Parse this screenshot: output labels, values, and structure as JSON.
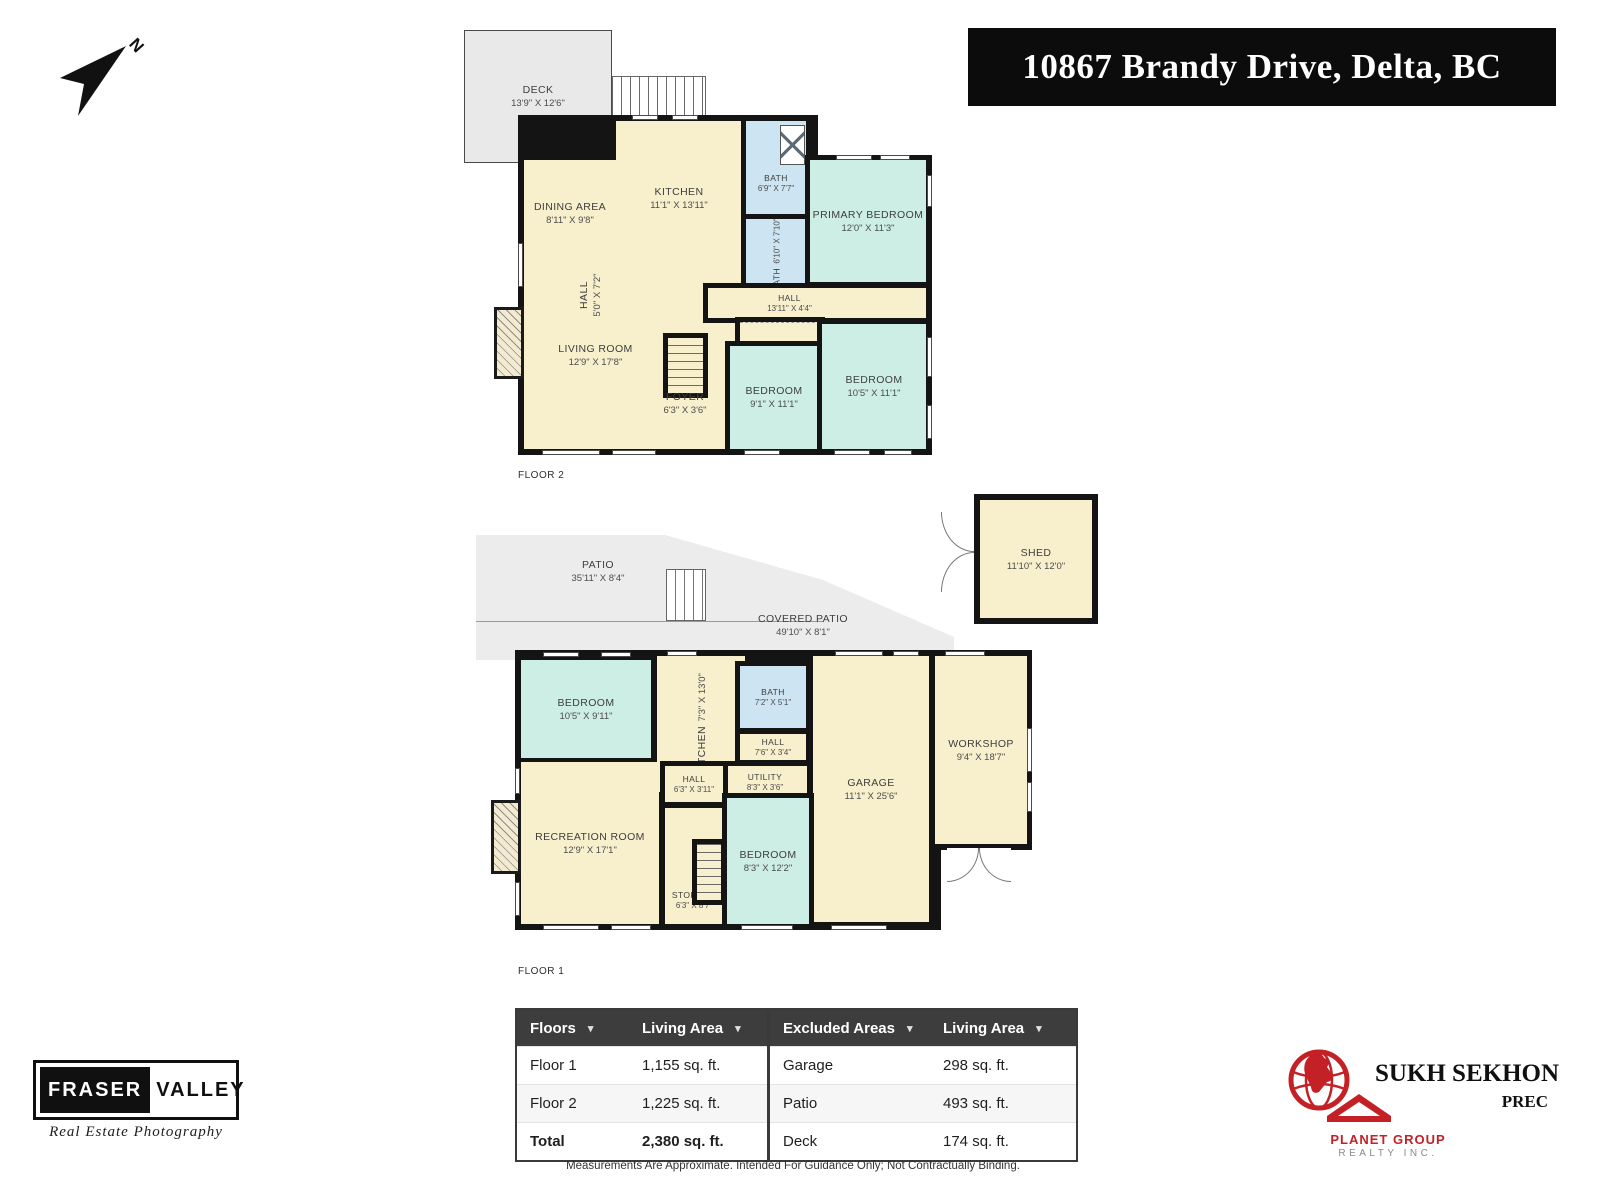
{
  "banner": {
    "text": "10867 Brandy Drive, Delta, BC",
    "bg": "#0c0c0c",
    "fg": "#ffffff"
  },
  "compass": {
    "label": "N"
  },
  "floor2": {
    "caption": "FLOOR 2",
    "rooms": {
      "deck": {
        "name": "DECK",
        "dims": "13'9\" X 12'6\""
      },
      "dining": {
        "name": "DINING AREA",
        "dims": "8'11\" X 9'8\""
      },
      "kitchen": {
        "name": "KITCHEN",
        "dims": "11'1\" X 13'11\""
      },
      "bath_upper": {
        "name": "BATH",
        "dims": "6'9\" X 7'7\""
      },
      "bath_lower": {
        "name": "BATH",
        "dims": "6'10\" X 7'10\""
      },
      "primary": {
        "name": "PRIMARY BEDROOM",
        "dims": "12'0\" X 11'3\""
      },
      "hall_small": {
        "name": "HALL",
        "dims": "5'0\" X 7'2\""
      },
      "hall": {
        "name": "HALL",
        "dims": "13'11\" X 4'4\""
      },
      "living": {
        "name": "LIVING ROOM",
        "dims": "12'9\" X 17'8\""
      },
      "foyer": {
        "name": "FOYER",
        "dims": "6'3\" X 3'6\""
      },
      "bedroom_a": {
        "name": "BEDROOM",
        "dims": "9'1\" X 11'1\""
      },
      "bedroom_b": {
        "name": "BEDROOM",
        "dims": "10'5\" X 11'1\""
      }
    }
  },
  "floor1": {
    "caption": "FLOOR 1",
    "rooms": {
      "patio": {
        "name": "PATIO",
        "dims": "35'11\" X 8'4\""
      },
      "covered_patio": {
        "name": "COVERED PATIO",
        "dims": "49'10\" X 8'1\""
      },
      "shed": {
        "name": "SHED",
        "dims": "11'10\" X 12'0\""
      },
      "bedroom_a": {
        "name": "BEDROOM",
        "dims": "10'5\" X 9'11\""
      },
      "kitchen": {
        "name": "KITCHEN",
        "dims": "7'3\" X 13'0\""
      },
      "bath": {
        "name": "BATH",
        "dims": "7'2\" X 5'1\""
      },
      "hall_a": {
        "name": "HALL",
        "dims": "7'6\" X 3'4\""
      },
      "utility": {
        "name": "UTILITY",
        "dims": "8'3\" X 3'6\""
      },
      "garage": {
        "name": "GARAGE",
        "dims": "11'1\" X 25'6\""
      },
      "workshop": {
        "name": "WORKSHOP",
        "dims": "9'4\" X 18'7\""
      },
      "rec": {
        "name": "RECREATION ROOM",
        "dims": "12'9\" X 17'1\""
      },
      "hall_b": {
        "name": "HALL",
        "dims": "6'3\" X 3'11\""
      },
      "storage": {
        "name": "STORAGE",
        "dims": "6'3\" X 8'7\""
      },
      "bedroom_b": {
        "name": "BEDROOM",
        "dims": "8'3\" X 12'2\""
      }
    }
  },
  "summary": {
    "headers": {
      "floors": "Floors",
      "living_area": "Living Area",
      "excluded": "Excluded Areas",
      "living_area2": "Living Area"
    },
    "floor_rows": [
      {
        "label": "Floor 1",
        "value": "1,155 sq. ft."
      },
      {
        "label": "Floor 2",
        "value": "1,225 sq. ft."
      },
      {
        "label": "Total",
        "value": "2,380 sq. ft."
      }
    ],
    "excluded_rows": [
      {
        "label": "Garage",
        "value": "298 sq. ft."
      },
      {
        "label": "Patio",
        "value": "493 sq. ft."
      },
      {
        "label": "Deck",
        "value": "174 sq. ft."
      }
    ],
    "disclaimer": "Measurements Are Approximate. Intended For Guidance Only; Not Contractually Binding."
  },
  "logos": {
    "photography": {
      "word1": "FRASER",
      "word2": "VALLEY",
      "tagline": "Real Estate Photography"
    },
    "agent": {
      "name": "SUKH SEKHON",
      "designation": "PREC",
      "company": "PLANET GROUP",
      "company2": "REALTY INC."
    }
  },
  "colors": {
    "wall": "#141414",
    "room_cream": "#f8efcd",
    "room_teal": "#cdeee4",
    "room_blue": "#cde4f2",
    "outdoor_gray": "#ececec",
    "accent_red": "#c42127",
    "table_header_bg": "#3d3d3d"
  }
}
